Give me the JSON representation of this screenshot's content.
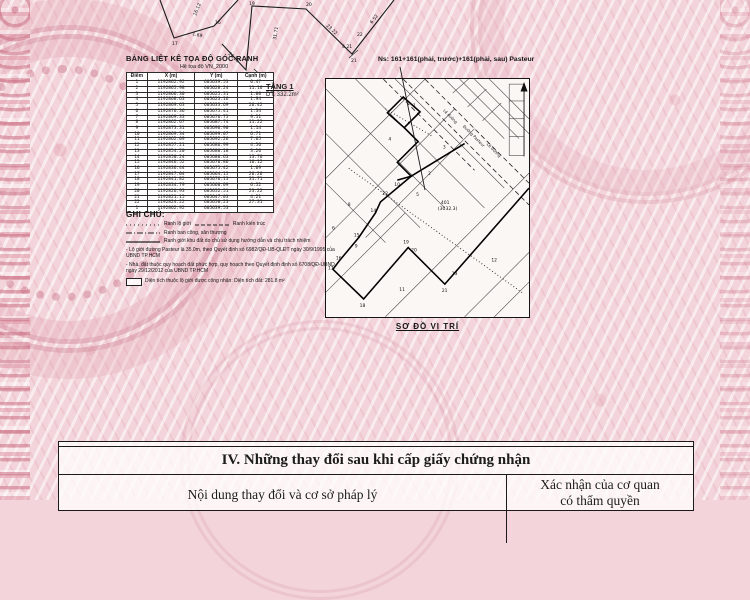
{
  "table": {
    "title": "BẢNG LIỆT KÊ TỌA ĐỘ GÓC RANH",
    "subtitle": "Hệ tọa độ VN_2000",
    "columns": [
      "Điểm",
      "X (m)",
      "Y (m)",
      "Cạnh (m)"
    ],
    "rows": [
      [
        "1",
        "1192862.92",
        "605639.53",
        "0.47"
      ],
      [
        "2",
        "1192865.98",
        "605628.24",
        "11.16"
      ],
      [
        "3",
        "1192866.30",
        "605625.31",
        "1.00"
      ],
      [
        "4",
        "1192868.63",
        "605623.16",
        "1.94"
      ],
      [
        "5",
        "1192869.63",
        "605633.69",
        "26.42"
      ],
      [
        "6",
        "1192876.36",
        "605675.41",
        "1.34"
      ],
      [
        "7",
        "1192869.33",
        "605676.75",
        "9.51"
      ],
      [
        "8",
        "1192862.67",
        "605687.74",
        "11.22"
      ],
      [
        "9",
        "1192873.31",
        "605696.90",
        "1.14"
      ],
      [
        "10",
        "1192869.34",
        "605699.07",
        "6.71"
      ],
      [
        "11",
        "1192862.09",
        "605692.26",
        "7.65"
      ],
      [
        "12",
        "1192857.21",
        "605686.99",
        "4.56"
      ],
      [
        "13",
        "1192854.20",
        "605680.18",
        "3.26"
      ],
      [
        "14",
        "1192850.24",
        "605686.63",
        "13.76"
      ],
      [
        "15",
        "1192846.52",
        "605676.86",
        "16.12"
      ],
      [
        "16",
        "1192836.44",
        "605675.42",
        "1.69"
      ],
      [
        "17",
        "1192847.04",
        "605664.15",
        "26.26"
      ],
      [
        "18",
        "1192841.82",
        "605676.13",
        "31.71"
      ],
      [
        "19",
        "1192834.79",
        "605660.09",
        "6.52"
      ],
      [
        "20",
        "1192826.93",
        "605652.51",
        "23.22"
      ],
      [
        "21",
        "1192821.15",
        "605647.03",
        "4.21"
      ],
      [
        "22",
        "1192824.22",
        "605650.23",
        "27.31"
      ],
      [
        "1",
        "1192862.92",
        "605639.53",
        ""
      ]
    ]
  },
  "floor": {
    "label": "TẦNG 1",
    "area": "DT: 332.2m²"
  },
  "survey": {
    "point_labels": [
      "15",
      "16",
      "17",
      "18",
      "19",
      "20",
      "21",
      "22"
    ],
    "edge_labels": [
      "16.12",
      "1.69",
      "26.26",
      "31.71",
      "23.22",
      "6.52",
      "4.21"
    ]
  },
  "map": {
    "address_label": "Ns: 161+161(phải, trước)+161(phải, sau) Pasteur",
    "caption": "SƠ ĐỒ VỊ TRÍ",
    "parcel_number": "401",
    "parcel_area": "(3032.3)",
    "street_label": "Đường Pasteur",
    "sidewalk_label_1": "Lề đường",
    "sidewalk_label_2": "Lề đường",
    "parcels": [
      "1",
      "2",
      "3",
      "4",
      "5",
      "6",
      "8",
      "9",
      "10",
      "11",
      "12",
      "13",
      "14",
      "15",
      "16",
      "17",
      "18",
      "19",
      "20",
      "21",
      "22"
    ]
  },
  "notes": {
    "heading": "GHI CHÚ:",
    "legend_lo_gioi": "Ranh lộ giới",
    "legend_kien_truc": "Ranh kiến trúc",
    "legend_ban_cong": "Ranh ban công, sân thượng",
    "legend_khu_dat": "Ranh giới khu đất do chủ sử dụng hướng dẫn và chịu trách nhiệm",
    "note1": "- Lộ giới đường Pasteur là 35.0m, theo Quyết định số 6982/QĐ-UB-QLĐT ngày 30/9/1995 của UBND TP.HCM",
    "note2": "- Nhà, đất thuộc quy hoạch đất phức hợp, quy hoạch theo Quyết định định số 6708/QĐ-UBND ngày 29/12/2012 của UBND TP.HCM",
    "area_note": "Diện tích thuộc lộ giới được công nhận: Diện tích đất:  281.8 m²"
  },
  "section4": {
    "title": "IV. Những thay đổi sau khi cấp giấy chứng nhận",
    "col_left": "Nội dung thay đổi và cơ sở pháp lý",
    "col_right": "Xác nhận của cơ quan",
    "col_right_line2": "có thẩm quyền"
  }
}
